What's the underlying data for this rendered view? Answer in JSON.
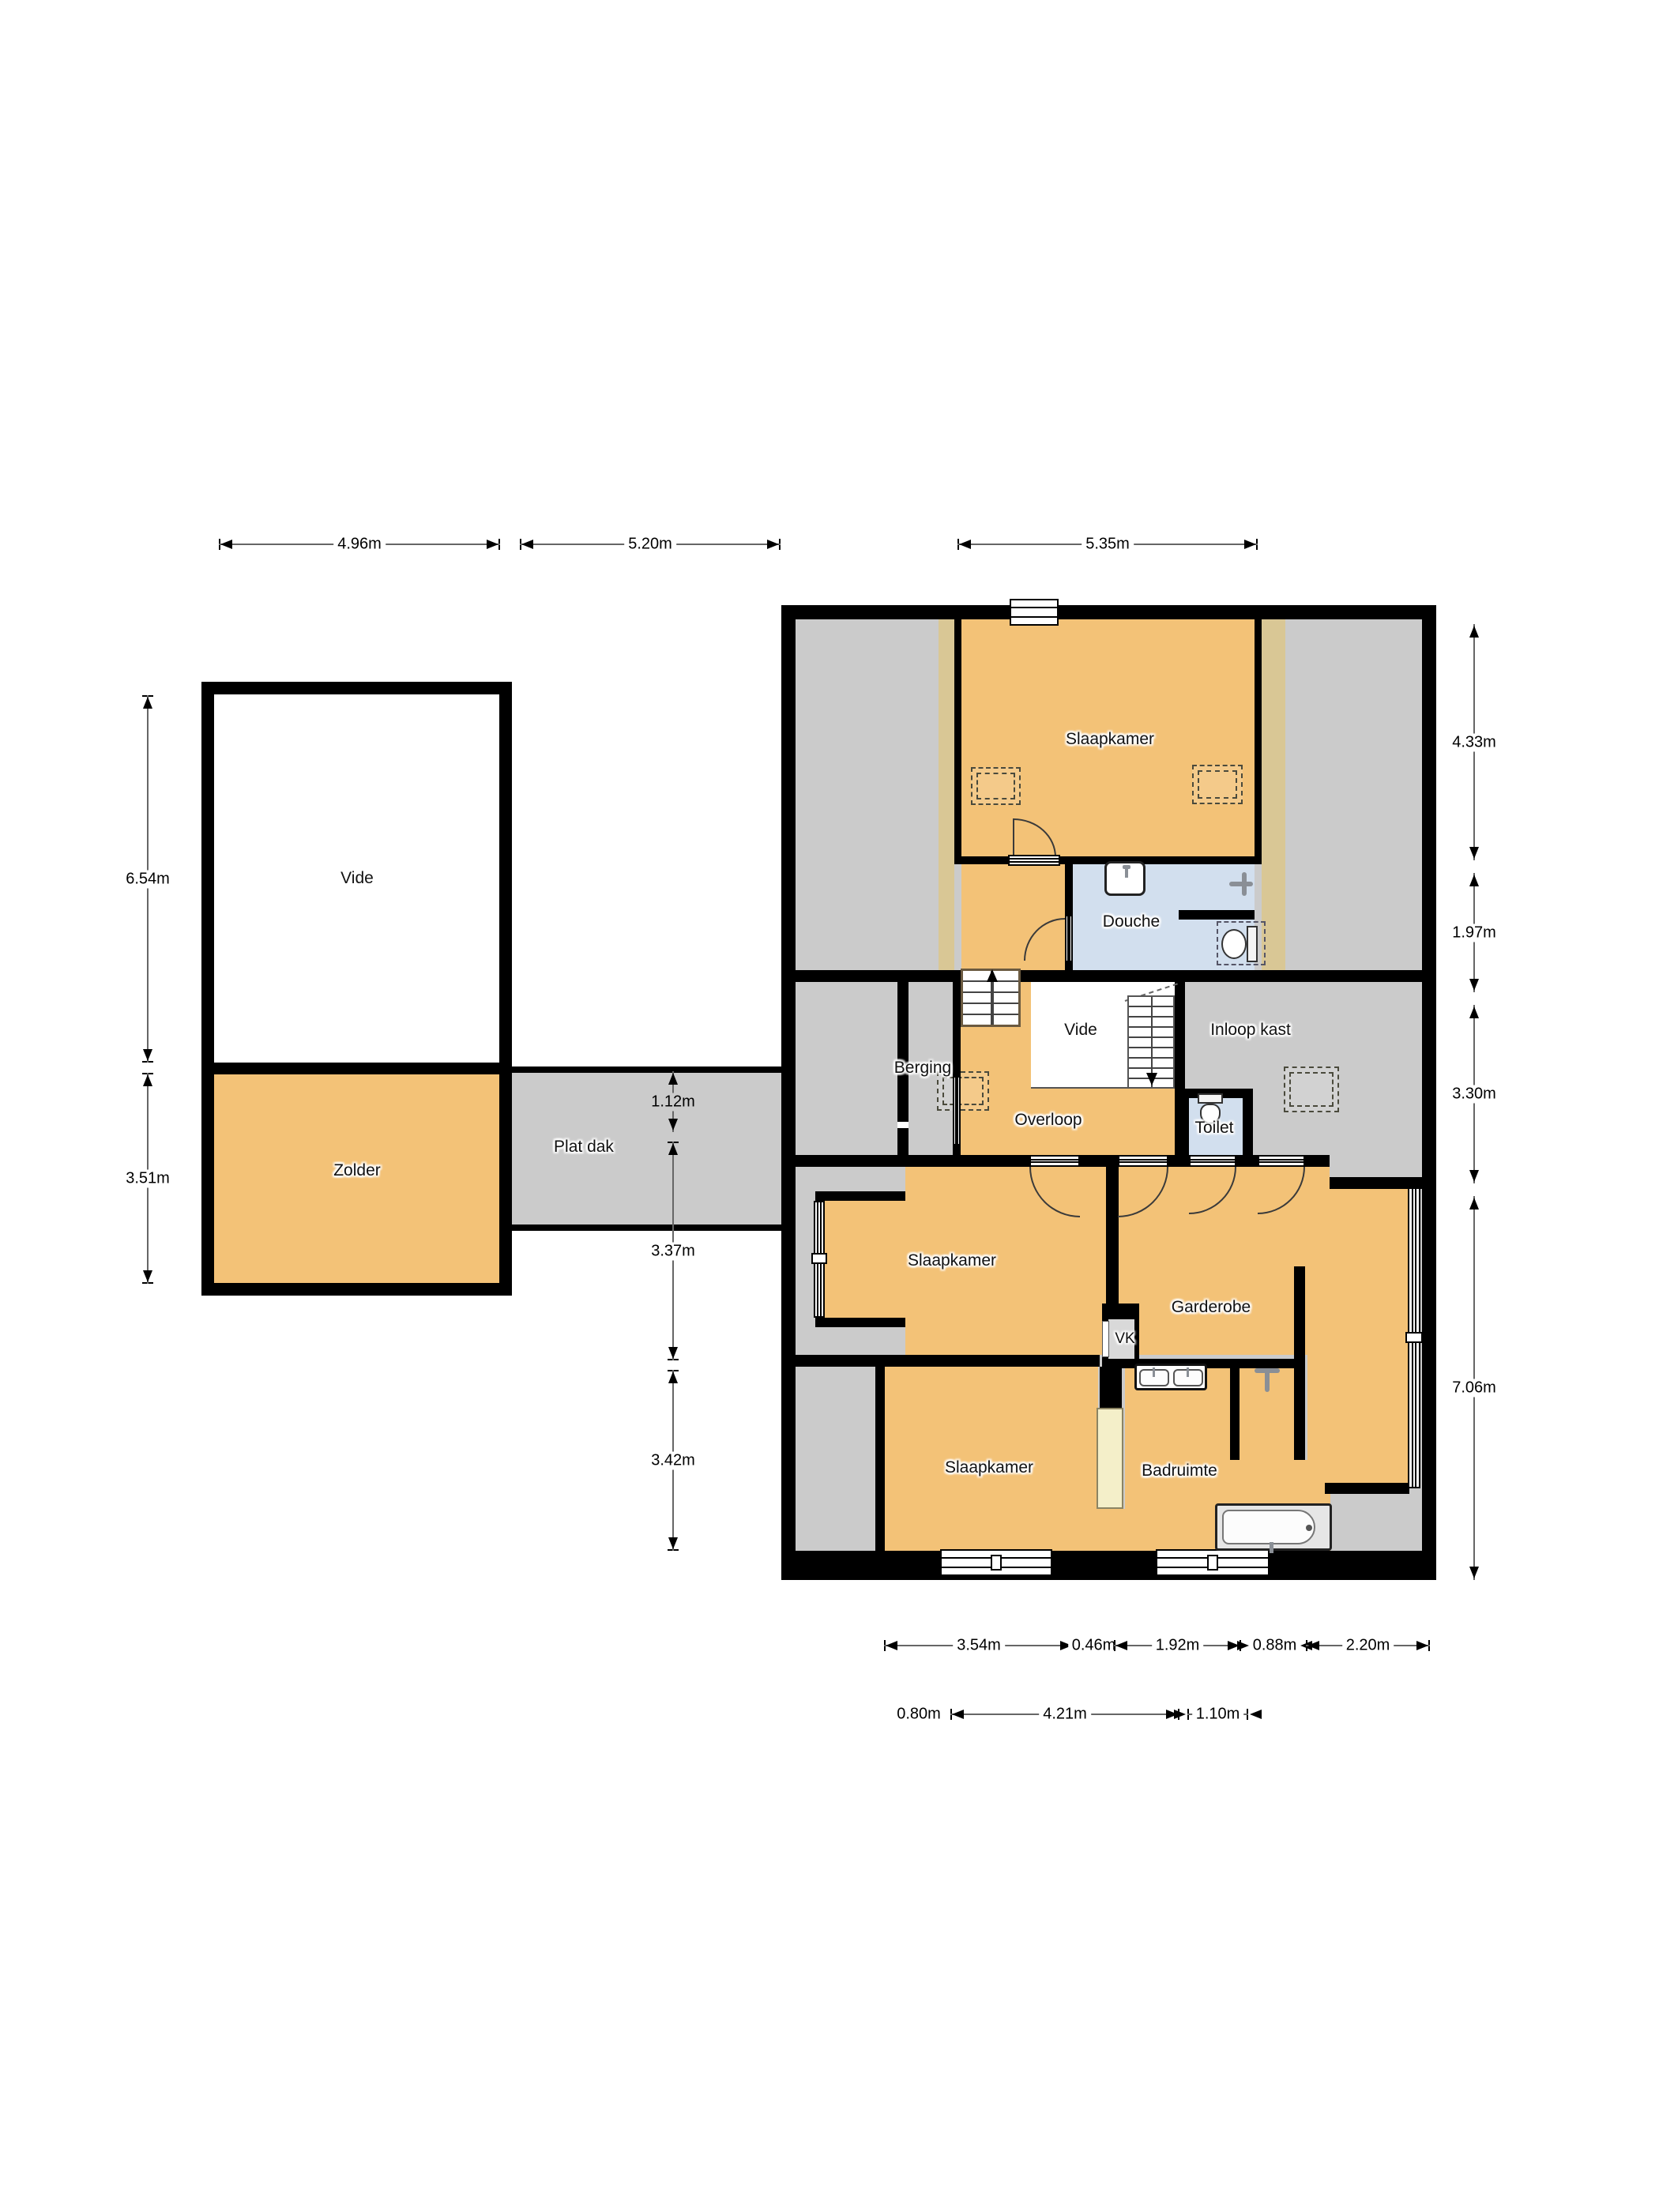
{
  "meta": {
    "type": "floor-plan"
  },
  "colors": {
    "wall": "#000000",
    "floor_orange": "#F3C277",
    "floor_gray": "#CBCBCB",
    "floor_blue": "#D2DFEE",
    "floor_white": "#FFFFFF",
    "roof_strip_tan": "#D9C795",
    "cabinet_cream": "#F4EFC9"
  },
  "rooms": {
    "vide_left": "Vide",
    "zolder": "Zolder",
    "plat_dak": "Plat dak",
    "slaapkamer_top": "Slaapkamer",
    "douche": "Douche",
    "vide_right": "Vide",
    "inloop_kast": "Inloop kast",
    "berging": "Berging",
    "overloop": "Overloop",
    "toilet": "Toilet",
    "slaapkamer_mid": "Slaapkamer",
    "garderobe": "Garderobe",
    "vk": "VK",
    "slaapkamer_bottom": "Slaapkamer",
    "badruimte": "Badruimte"
  },
  "dimensions": {
    "top": [
      "4.96m",
      "5.20m",
      "5.35m"
    ],
    "left": [
      "6.54m",
      "3.51m"
    ],
    "middle": [
      "1.12m",
      "3.37m",
      "3.42m"
    ],
    "right": [
      "4.33m",
      "1.97m",
      "3.30m",
      "7.06m"
    ],
    "bottom_row1": [
      "3.54m",
      "0.46m",
      "1.92m",
      "0.88m",
      "2.20m"
    ],
    "bottom_row2": [
      "0.80m",
      "4.21m",
      "1.10m"
    ]
  },
  "icons": {
    "toilet": "toilet-icon",
    "sink": "sink-icon",
    "double_sink": "double-sink-icon",
    "bathtub": "bathtub-icon",
    "shower_mixer": "shower-faucet-icon",
    "stairs_up": "stairs-up-icon",
    "stairs_down": "stairs-down-icon",
    "skylight": "skylight-dashed-box",
    "window": "window-icon",
    "door": "door-arc-icon"
  }
}
